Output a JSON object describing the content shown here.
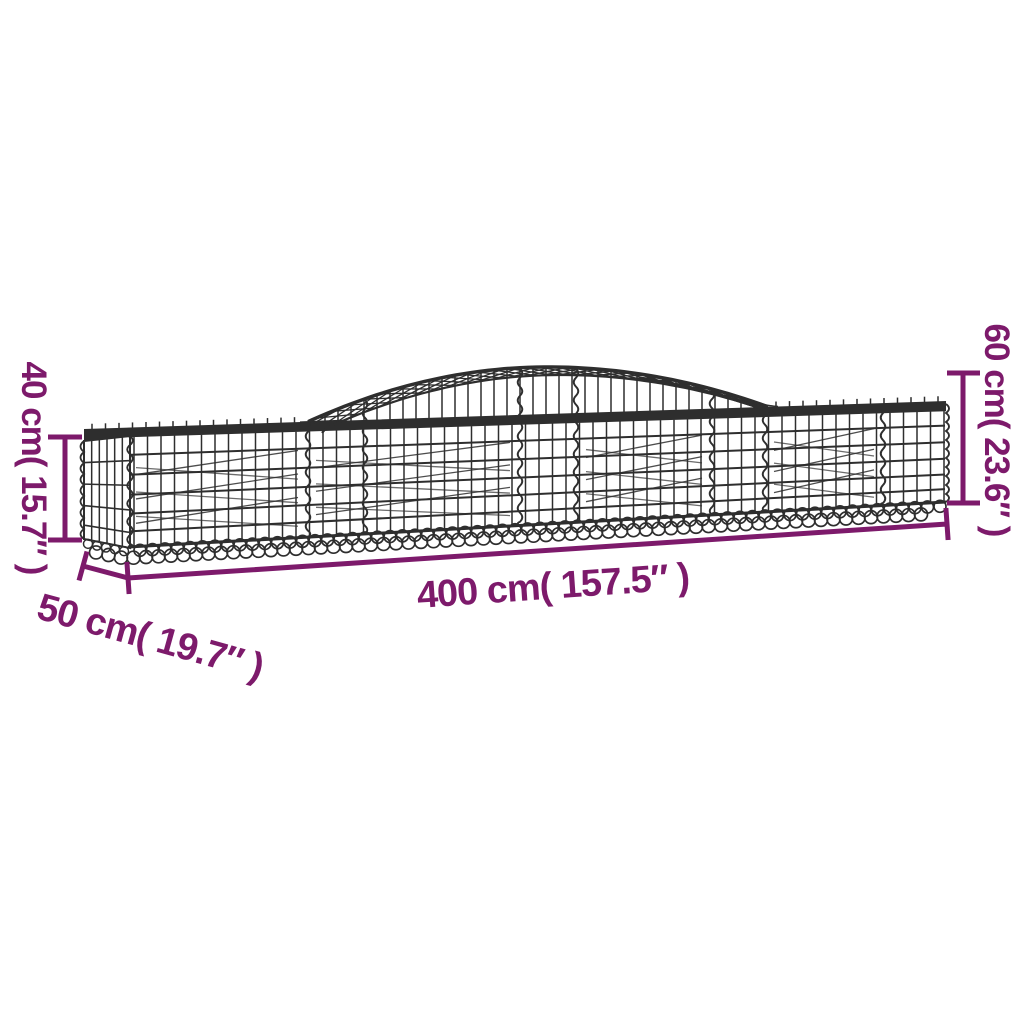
{
  "diagram": {
    "accent_color": "#7D1A6B",
    "wire_color": "#2e2e2e",
    "labels": {
      "height_front": "40 cm( 15.7″ )",
      "depth": "50 cm( 19.7″ )",
      "length": "400 cm( 157.5″ )",
      "height_total": "60 cm( 23.6″ )"
    }
  }
}
